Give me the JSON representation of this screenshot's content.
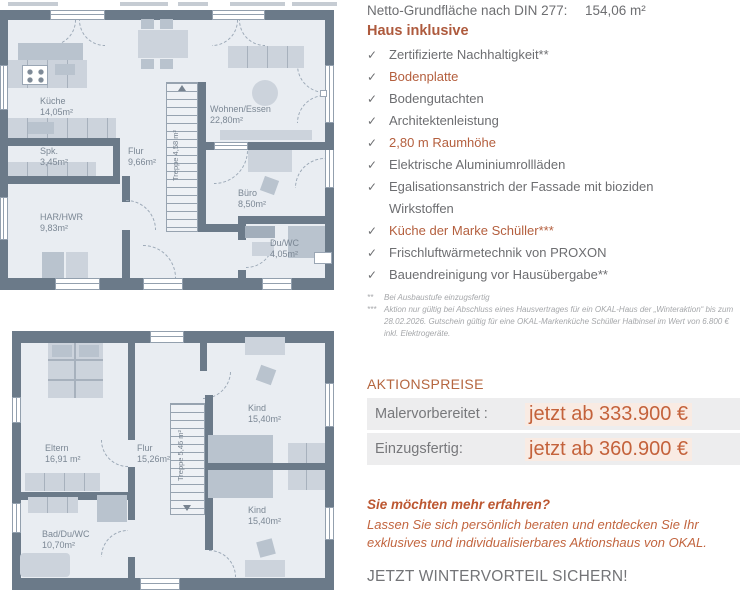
{
  "colors": {
    "accent_orange": "#b45f3e",
    "price_orange": "#c4623b",
    "text_gray": "#6d6e71",
    "wall": "#6b7a89",
    "floor": "#e9edf2"
  },
  "icons": {
    "check_glyph": "✓"
  },
  "floor_plans": {
    "ground_floor": {
      "rooms": [
        {
          "name": "Küche",
          "area": "14,05m²"
        },
        {
          "name": "Spk.",
          "area": "3,45m²"
        },
        {
          "name": "HAR/HWR",
          "area": "9,83m²"
        },
        {
          "name": "Flur",
          "area": "9,66m²"
        },
        {
          "name": "Wohnen/Essen",
          "area": "22,80m²"
        },
        {
          "name": "Büro",
          "area": "8,50m²"
        },
        {
          "name": "Du/WC",
          "area": "4,05m²"
        }
      ],
      "stairs": {
        "name": "Treppe",
        "area": "4,58 m²"
      }
    },
    "upper_floor": {
      "rooms": [
        {
          "name": "Eltern",
          "area": "16,91 m²"
        },
        {
          "name": "Flur",
          "area": "15,26m²"
        },
        {
          "name": "Kind",
          "area": "15,40m²"
        },
        {
          "name": "Kind",
          "area": "15,40m²"
        },
        {
          "name": "Bad/Du/WC",
          "area": "10,70m²"
        }
      ],
      "stairs": {
        "name": "Treppe",
        "area": "5,46 m²"
      }
    }
  },
  "info_panel": {
    "netto_label": "Netto-Grundfläche nach DIN 277:",
    "netto_value": "154,06 m²",
    "inclusive_title": "Haus inklusive",
    "items": [
      {
        "text": "Zertifizierte Nachhaltigkeit**",
        "highlight": false
      },
      {
        "text": "Bodenplatte",
        "highlight": true
      },
      {
        "text": "Bodengutachten",
        "highlight": false
      },
      {
        "text": "Architektenleistung",
        "highlight": false
      },
      {
        "text": "2,80 m Raumhöhe",
        "highlight": true
      },
      {
        "text": "Elektrische Aluminiumrollläden",
        "highlight": false
      },
      {
        "text": "Egalisationsanstrich der Fassade mit bioziden Wirkstoffen",
        "highlight": false
      },
      {
        "text": "Küche der Marke Schüller***",
        "highlight": true
      },
      {
        "text": "Frischluftwärmetechnik von PROXON",
        "highlight": false
      },
      {
        "text": "Bauendreinigung vor Hausübergabe**",
        "highlight": false
      }
    ],
    "footnotes": [
      {
        "marker": "**",
        "text": "Bei Ausbaustufe einzugsfertig"
      },
      {
        "marker": "***",
        "text": "Aktion nur gültig bei Abschluss eines Hausvertrages für ein OKAL-Haus der „Winteraktion“ bis zum 28.02.2026. Gutschein gültig für eine OKAL-Markenküche Schüller Halbinsel im Wert von 6.800 €  inkl. Elektrogeräte."
      }
    ],
    "prices_title": "AKTIONSPREISE",
    "prices": [
      {
        "label": "Malervorbereitet :",
        "value": "jetzt ab 333.900 €"
      },
      {
        "label": "Einzugsfertig:",
        "value": "jetzt ab 360.900 €"
      }
    ],
    "cta_question": "Sie möchten mehr erfahren?",
    "cta_body": "Lassen Sie sich persönlich beraten und entdecken Sie Ihr exklusives und individualisierbares Aktionshaus von OKAL.",
    "cta_footer": "JETZT WINTERVORTEIL SICHERN!"
  }
}
